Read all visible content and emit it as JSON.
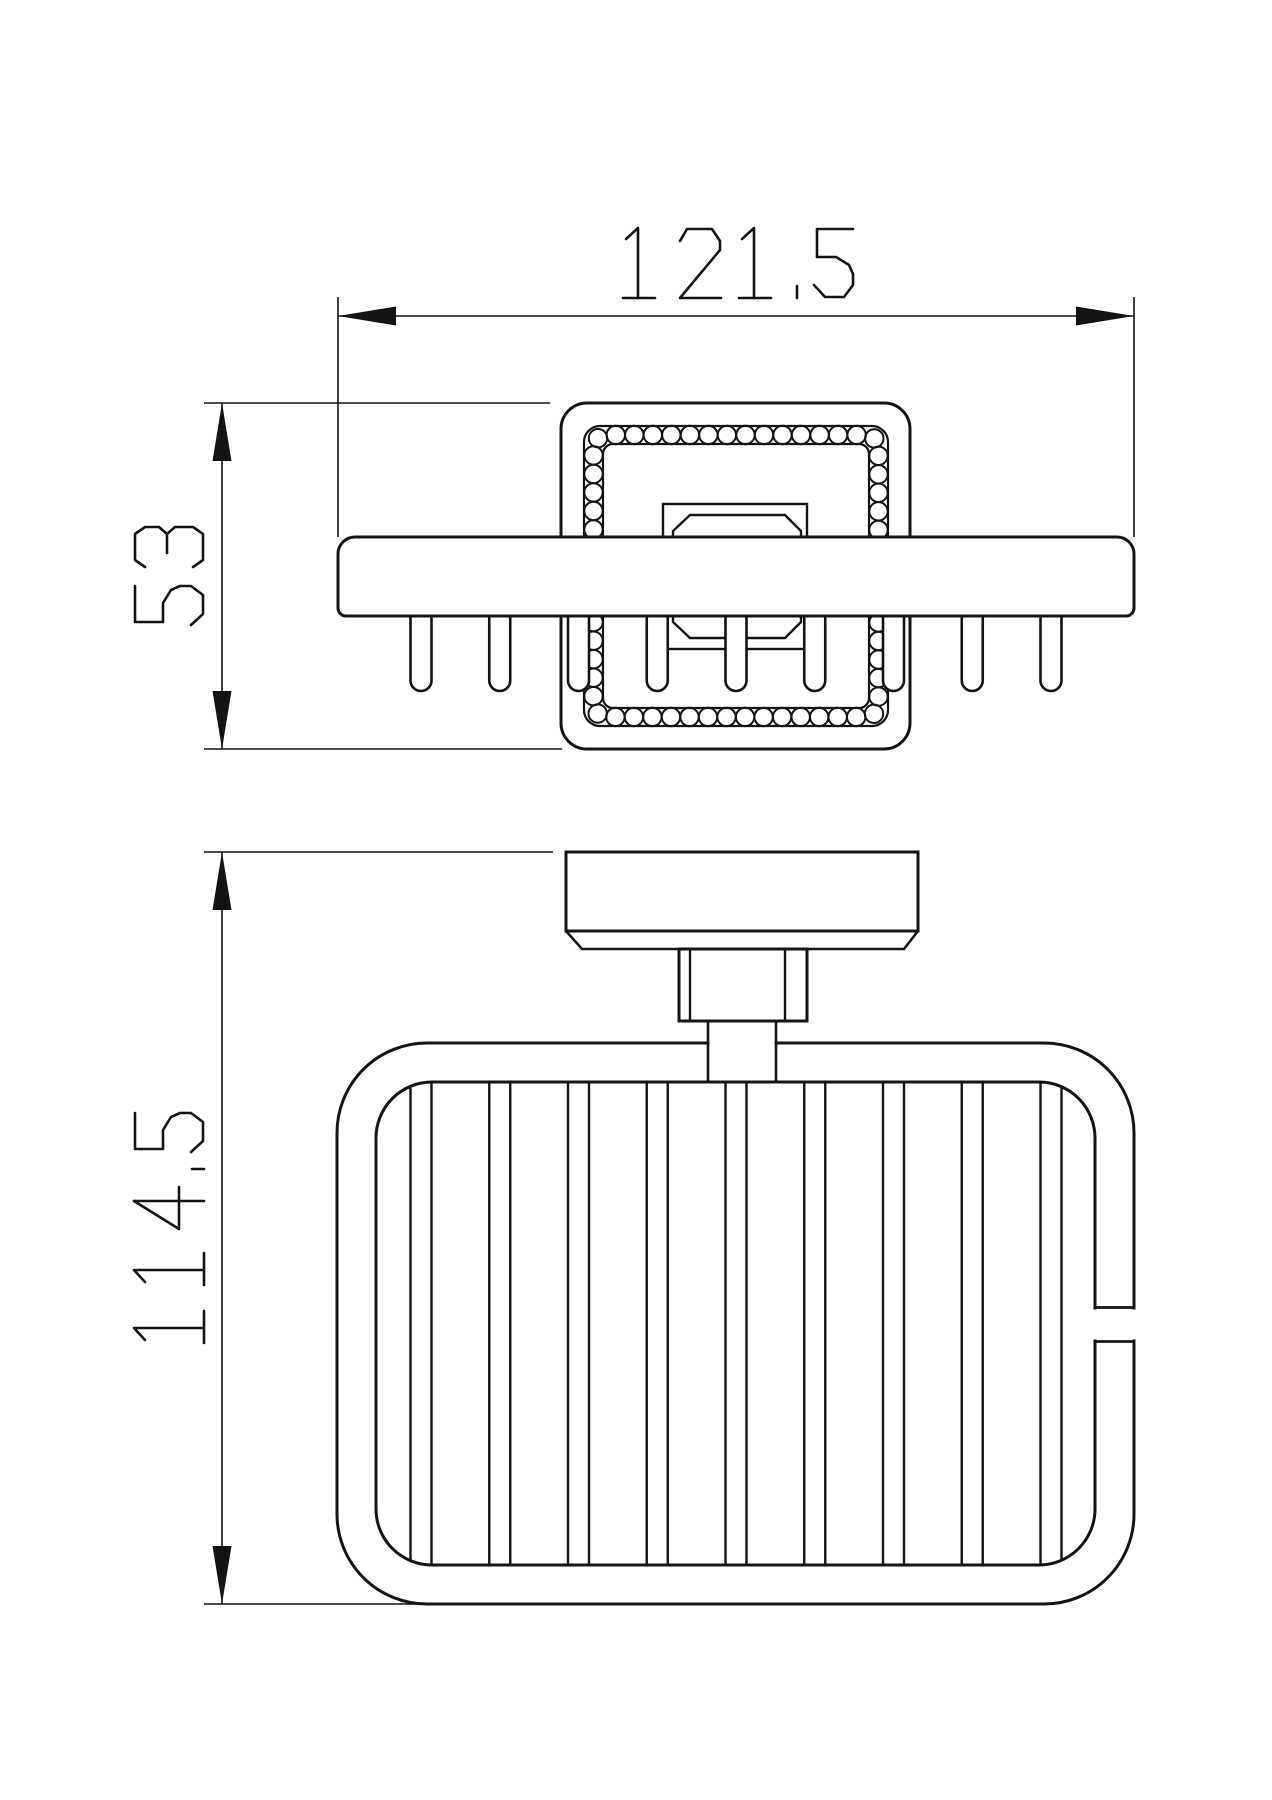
{
  "drawing": {
    "type": "orthographic technical drawing of a wall-mounted soap basket",
    "views": [
      {
        "id": "top-view",
        "description": "bracket plate with crystal-beaded border, rail and basket rods seen from above"
      },
      {
        "id": "front-view",
        "description": "wall plate, mounting post and wire soap basket seen from the front"
      }
    ],
    "dimensions": [
      {
        "id": "overall-width",
        "value": "121.5",
        "orientation": "horizontal"
      },
      {
        "id": "bracket-height",
        "value": "53",
        "orientation": "vertical"
      },
      {
        "id": "overall-height",
        "value": "114.5",
        "orientation": "vertical"
      }
    ],
    "colors": {
      "line": "#141414",
      "background": "#ffffff"
    }
  }
}
